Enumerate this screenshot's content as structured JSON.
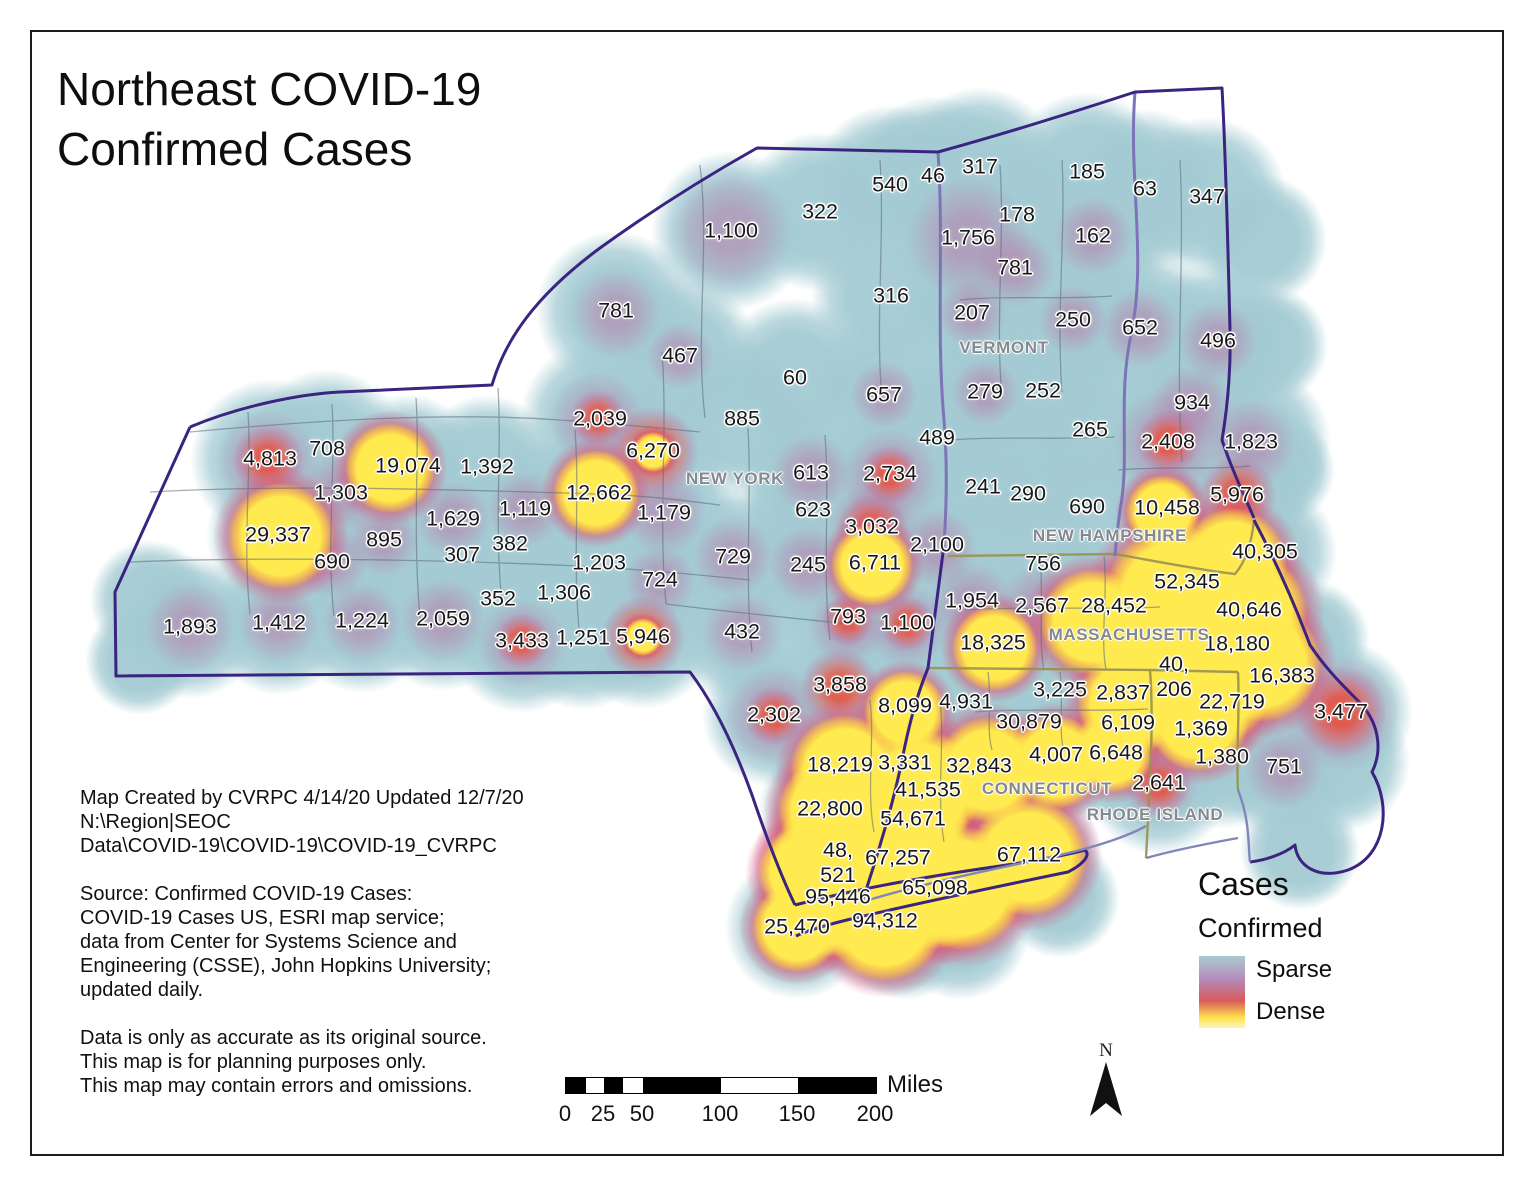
{
  "title": {
    "line1": "Northeast COVID-19",
    "line2": "Confirmed Cases"
  },
  "credits": {
    "created_lines": [
      "Map Created by CVRPC 4/14/20 Updated 12/7/20",
      "N:\\Region|SEOC",
      "Data\\COVID-19\\COVID-19\\COVID-19_CVRPC"
    ],
    "source_lines": [
      "Source: Confirmed COVID-19 Cases:",
      "COVID-19 Cases US, ESRI map service;",
      "data from Center for Systems Science and",
      "Engineering (CSSE), John Hopkins University;",
      "updated daily."
    ],
    "disclaimer_lines": [
      "Data is only as accurate as its original source.",
      "This map is for planning purposes only.",
      "This map may contain errors and omissions."
    ]
  },
  "legend": {
    "title": "Cases",
    "subtitle": "Confirmed",
    "items": [
      {
        "label": "Sparse"
      },
      {
        "label": "Dense"
      }
    ],
    "colors": {
      "sparse": "#a9cbd3",
      "mid": "#b48cba",
      "red": "#d95a5c",
      "dense": "#ffe44e"
    }
  },
  "scale_bar": {
    "tick_labels": [
      "0",
      "25",
      "50",
      "100",
      "150",
      "200"
    ],
    "unit_label": "Miles"
  },
  "north_arrow_label": "N",
  "map": {
    "state_labels": [
      {
        "name": "NEW YORK",
        "x": 735,
        "y": 479
      },
      {
        "name": "VERMONT",
        "x": 1004,
        "y": 348
      },
      {
        "name": "NEW HAMPSHIRE",
        "x": 1110,
        "y": 536
      },
      {
        "name": "MASSACHUSETTS",
        "x": 1129,
        "y": 635
      },
      {
        "name": "CONNECTICUT",
        "x": 1047,
        "y": 789
      },
      {
        "name": "RHODE ISLAND",
        "x": 1155,
        "y": 815
      }
    ],
    "case_labels": [
      {
        "v": "1,100",
        "x": 731,
        "y": 231
      },
      {
        "v": "322",
        "x": 820,
        "y": 212
      },
      {
        "v": "540",
        "x": 890,
        "y": 185
      },
      {
        "v": "46",
        "x": 933,
        "y": 176
      },
      {
        "v": "317",
        "x": 980,
        "y": 167
      },
      {
        "v": "185",
        "x": 1087,
        "y": 172
      },
      {
        "v": "63",
        "x": 1145,
        "y": 189
      },
      {
        "v": "347",
        "x": 1207,
        "y": 197
      },
      {
        "v": "178",
        "x": 1017,
        "y": 215
      },
      {
        "v": "1,756",
        "x": 968,
        "y": 238
      },
      {
        "v": "162",
        "x": 1093,
        "y": 236
      },
      {
        "v": "781",
        "x": 1015,
        "y": 268
      },
      {
        "v": "316",
        "x": 891,
        "y": 296
      },
      {
        "v": "207",
        "x": 972,
        "y": 313
      },
      {
        "v": "250",
        "x": 1073,
        "y": 320
      },
      {
        "v": "652",
        "x": 1140,
        "y": 328
      },
      {
        "v": "496",
        "x": 1218,
        "y": 341
      },
      {
        "v": "279",
        "x": 985,
        "y": 392
      },
      {
        "v": "252",
        "x": 1043,
        "y": 391
      },
      {
        "v": "265",
        "x": 1090,
        "y": 430
      },
      {
        "v": "934",
        "x": 1192,
        "y": 403
      },
      {
        "v": "2,408",
        "x": 1168,
        "y": 442
      },
      {
        "v": "1,823",
        "x": 1251,
        "y": 442
      },
      {
        "v": "781",
        "x": 616,
        "y": 311
      },
      {
        "v": "467",
        "x": 680,
        "y": 356
      },
      {
        "v": "60",
        "x": 795,
        "y": 378
      },
      {
        "v": "885",
        "x": 742,
        "y": 419
      },
      {
        "v": "657",
        "x": 884,
        "y": 395
      },
      {
        "v": "489",
        "x": 937,
        "y": 438
      },
      {
        "v": "2,039",
        "x": 600,
        "y": 419
      },
      {
        "v": "6,270",
        "x": 653,
        "y": 451
      },
      {
        "v": "4,813",
        "x": 270,
        "y": 459
      },
      {
        "v": "708",
        "x": 327,
        "y": 449
      },
      {
        "v": "19,074",
        "x": 408,
        "y": 466
      },
      {
        "v": "1,392",
        "x": 487,
        "y": 467
      },
      {
        "v": "613",
        "x": 811,
        "y": 473
      },
      {
        "v": "2,734",
        "x": 890,
        "y": 474
      },
      {
        "v": "1,303",
        "x": 341,
        "y": 493
      },
      {
        "v": "12,662",
        "x": 599,
        "y": 493
      },
      {
        "v": "1,119",
        "x": 525,
        "y": 509
      },
      {
        "v": "1,179",
        "x": 664,
        "y": 513
      },
      {
        "v": "623",
        "x": 813,
        "y": 510
      },
      {
        "v": "241",
        "x": 983,
        "y": 487
      },
      {
        "v": "290",
        "x": 1028,
        "y": 494
      },
      {
        "v": "690",
        "x": 1087,
        "y": 507
      },
      {
        "v": "10,458",
        "x": 1167,
        "y": 508
      },
      {
        "v": "5,976",
        "x": 1237,
        "y": 495
      },
      {
        "v": "1,629",
        "x": 453,
        "y": 519
      },
      {
        "v": "29,337",
        "x": 278,
        "y": 535
      },
      {
        "v": "895",
        "x": 384,
        "y": 540
      },
      {
        "v": "307",
        "x": 462,
        "y": 555
      },
      {
        "v": "382",
        "x": 510,
        "y": 544
      },
      {
        "v": "3,032",
        "x": 872,
        "y": 527
      },
      {
        "v": "2,100",
        "x": 937,
        "y": 545
      },
      {
        "v": "40,305",
        "x": 1265,
        "y": 552
      },
      {
        "v": "690",
        "x": 332,
        "y": 562
      },
      {
        "v": "1,203",
        "x": 599,
        "y": 563
      },
      {
        "v": "729",
        "x": 733,
        "y": 557
      },
      {
        "v": "245",
        "x": 808,
        "y": 565
      },
      {
        "v": "6,711",
        "x": 875,
        "y": 563
      },
      {
        "v": "756",
        "x": 1043,
        "y": 564
      },
      {
        "v": "52,345",
        "x": 1187,
        "y": 582
      },
      {
        "v": "352",
        "x": 498,
        "y": 599
      },
      {
        "v": "1,306",
        "x": 564,
        "y": 593
      },
      {
        "v": "724",
        "x": 660,
        "y": 580
      },
      {
        "v": "1,954",
        "x": 972,
        "y": 601
      },
      {
        "v": "2,567",
        "x": 1042,
        "y": 606
      },
      {
        "v": "28,452",
        "x": 1114,
        "y": 606
      },
      {
        "v": "40,646",
        "x": 1249,
        "y": 610
      },
      {
        "v": "1,893",
        "x": 190,
        "y": 627
      },
      {
        "v": "1,412",
        "x": 279,
        "y": 623
      },
      {
        "v": "1,224",
        "x": 362,
        "y": 621
      },
      {
        "v": "2,059",
        "x": 443,
        "y": 619
      },
      {
        "v": "432",
        "x": 742,
        "y": 632
      },
      {
        "v": "793",
        "x": 848,
        "y": 617
      },
      {
        "v": "1,100",
        "x": 907,
        "y": 623
      },
      {
        "v": "18,325",
        "x": 993,
        "y": 643
      },
      {
        "v": "18,180",
        "x": 1237,
        "y": 644
      },
      {
        "v": "3,433",
        "x": 522,
        "y": 641
      },
      {
        "v": "1,251",
        "x": 583,
        "y": 638
      },
      {
        "v": "5,946",
        "x": 643,
        "y": 637
      },
      {
        "v": "40,\n206",
        "x": 1174,
        "y": 677
      },
      {
        "v": "16,383",
        "x": 1282,
        "y": 676
      },
      {
        "v": "3,858",
        "x": 840,
        "y": 685
      },
      {
        "v": "2,302",
        "x": 774,
        "y": 715
      },
      {
        "v": "8,099",
        "x": 905,
        "y": 706
      },
      {
        "v": "4,931",
        "x": 966,
        "y": 702
      },
      {
        "v": "3,225",
        "x": 1060,
        "y": 690
      },
      {
        "v": "2,837",
        "x": 1123,
        "y": 693
      },
      {
        "v": "22,719",
        "x": 1232,
        "y": 702
      },
      {
        "v": "30,879",
        "x": 1029,
        "y": 722
      },
      {
        "v": "6,109",
        "x": 1128,
        "y": 723
      },
      {
        "v": "1,369",
        "x": 1201,
        "y": 729
      },
      {
        "v": "3,477",
        "x": 1341,
        "y": 712
      },
      {
        "v": "18,219",
        "x": 840,
        "y": 765
      },
      {
        "v": "3,331",
        "x": 905,
        "y": 763
      },
      {
        "v": "32,843",
        "x": 979,
        "y": 766
      },
      {
        "v": "4,007",
        "x": 1056,
        "y": 755
      },
      {
        "v": "6,648",
        "x": 1116,
        "y": 753
      },
      {
        "v": "1,380",
        "x": 1222,
        "y": 757
      },
      {
        "v": "41,535",
        "x": 928,
        "y": 790
      },
      {
        "v": "2,641",
        "x": 1159,
        "y": 783
      },
      {
        "v": "751",
        "x": 1284,
        "y": 767
      },
      {
        "v": "22,800",
        "x": 830,
        "y": 809
      },
      {
        "v": "54,671",
        "x": 913,
        "y": 819
      },
      {
        "v": "48,\n521",
        "x": 838,
        "y": 863
      },
      {
        "v": "67,257",
        "x": 898,
        "y": 858
      },
      {
        "v": "67,112",
        "x": 1029,
        "y": 855
      },
      {
        "v": "95,446",
        "x": 838,
        "y": 897
      },
      {
        "v": "65,098",
        "x": 935,
        "y": 888
      },
      {
        "v": "25,470",
        "x": 797,
        "y": 927
      },
      {
        "v": "94,312",
        "x": 885,
        "y": 921
      }
    ]
  }
}
